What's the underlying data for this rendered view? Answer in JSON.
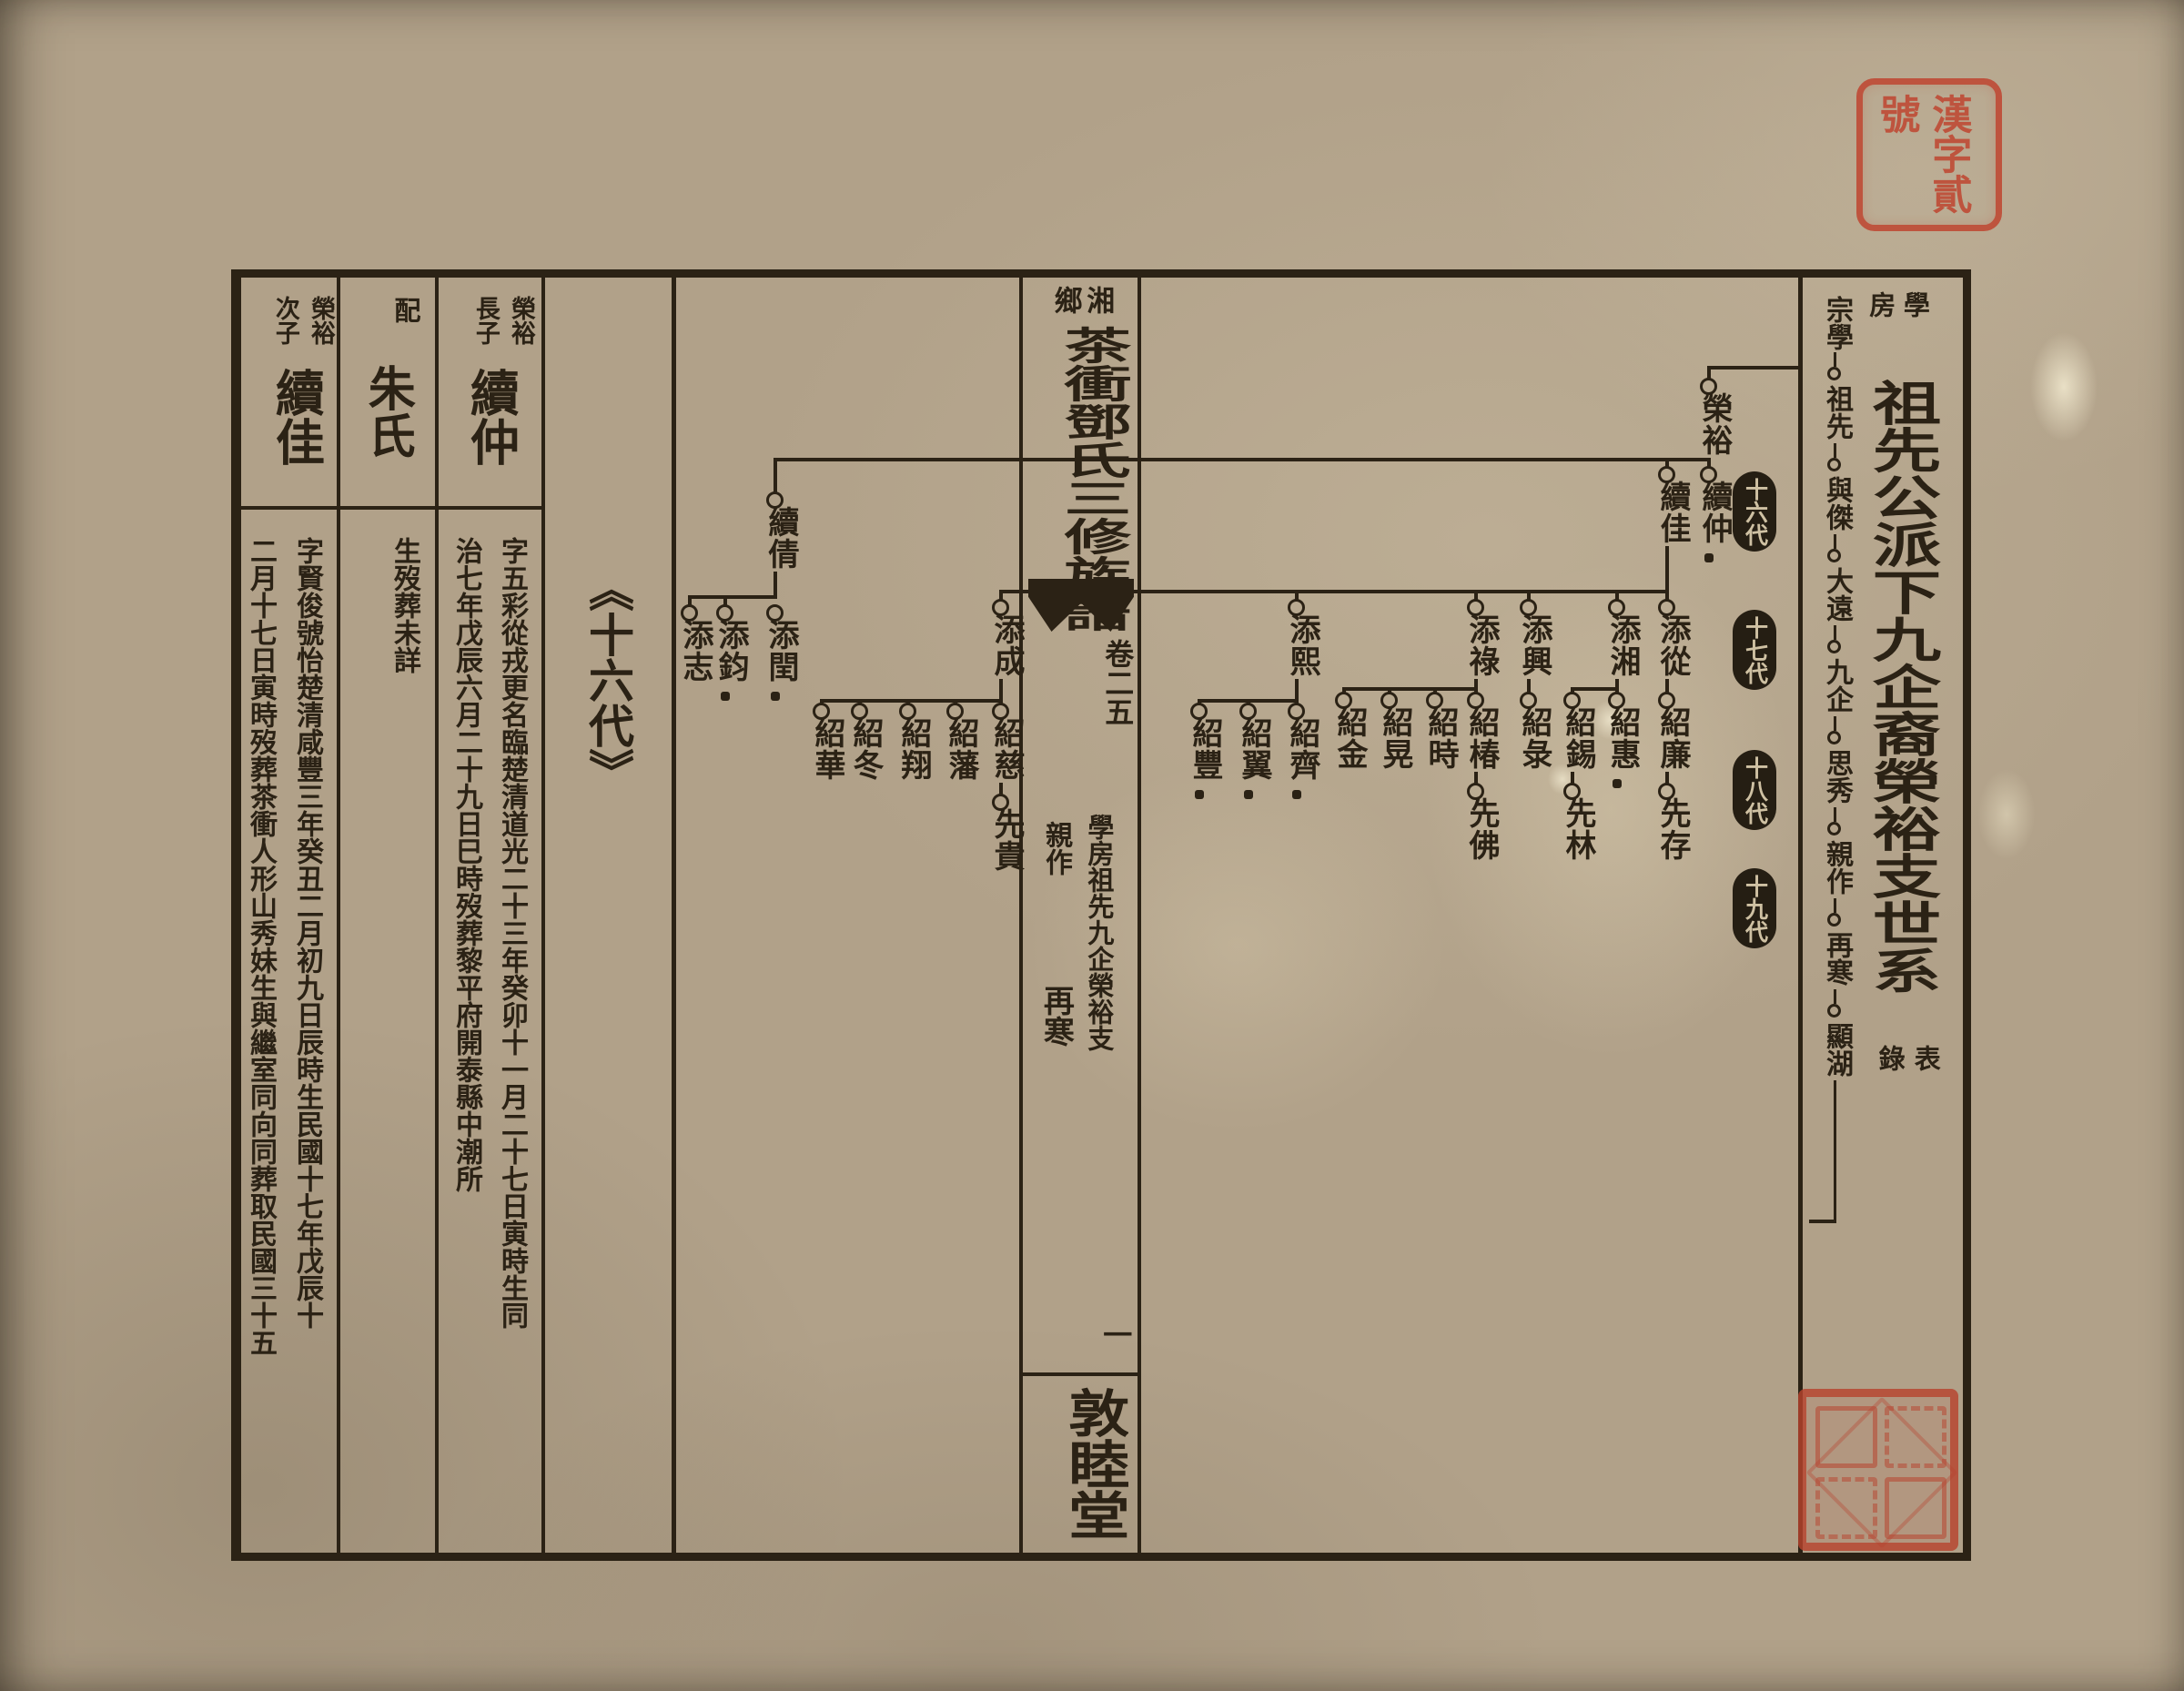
{
  "seals": {
    "registration": {
      "text": "漢字貳號",
      "color": "#bf4530"
    },
    "collection": {
      "note": "篆書藏書印"
    }
  },
  "right_panel": {
    "branch_small": "學房",
    "title_main": "祖先公派下九企裔榮裕支世系",
    "title_suffix": "表錄",
    "chain_head": "宗學",
    "chain": [
      {
        "name": "祖先"
      },
      {
        "name": "與傑"
      },
      {
        "name": "大遠"
      },
      {
        "name": "九企"
      },
      {
        "name": "思秀"
      },
      {
        "name": "親作"
      },
      {
        "name": "再寒"
      },
      {
        "name": "顯湖"
      }
    ]
  },
  "fold_column": {
    "place": "湘鄉",
    "book_title": "茶衝鄧氏三修族譜",
    "volume": "卷二五",
    "section": "學房祖先九企榮裕支",
    "compiler_top": "親作",
    "compiler_bottom": "再寒",
    "page_number": "一",
    "hall_name": "敦睦堂"
  },
  "tree": {
    "generation_labels": [
      {
        "label": "十六代"
      },
      {
        "label": "十七代"
      },
      {
        "label": "十八代"
      },
      {
        "label": "十九代"
      }
    ],
    "nodes": [
      {
        "name": "榮裕"
      },
      {
        "name": "續仲",
        "stop": true
      },
      {
        "name": "續佳"
      },
      {
        "name": "續倩"
      },
      {
        "name": "添從"
      },
      {
        "name": "添湘"
      },
      {
        "name": "添興"
      },
      {
        "name": "添祿"
      },
      {
        "name": "添熙"
      },
      {
        "name": "添成"
      },
      {
        "name": "添閏",
        "stop": true
      },
      {
        "name": "添鈞",
        "stop": true
      },
      {
        "name": "添志"
      },
      {
        "name": "紹廉"
      },
      {
        "name": "紹惠",
        "stop": true
      },
      {
        "name": "紹錫"
      },
      {
        "name": "紹彔"
      },
      {
        "name": "紹椿"
      },
      {
        "name": "紹時"
      },
      {
        "name": "紹晃"
      },
      {
        "name": "紹金"
      },
      {
        "name": "紹齊",
        "stop": true
      },
      {
        "name": "紹翼",
        "stop": true
      },
      {
        "name": "紹豐",
        "stop": true
      },
      {
        "name": "紹慈"
      },
      {
        "name": "紹藩"
      },
      {
        "name": "紹翔"
      },
      {
        "name": "紹冬"
      },
      {
        "name": "紹華"
      },
      {
        "name": "先存"
      },
      {
        "name": "先林"
      },
      {
        "name": "先佛"
      },
      {
        "name": "先貴"
      }
    ]
  },
  "left_panel": {
    "generation_marker": "《十六代》",
    "entries": [
      {
        "relation": "榮裕長子",
        "name": "續仲",
        "bio1": "字五彩從戎更名臨楚",
        "bio2": "清道光二十三年癸卯十一月二十七日寅時生同",
        "bio3": "治七年戊辰六月二十九日巳時歿葬黎平府開泰縣中潮所"
      },
      {
        "relation": "配",
        "name": "朱氏",
        "bio1": "生歿葬未詳"
      },
      {
        "relation": "榮裕次子",
        "name": "續佳",
        "bio1": "字賢俊號怡楚",
        "bio2": "清咸豐三年癸丑二月初九日辰時生民國十七年戊辰十",
        "bio3": "二月十七日寅時歿葬茶衝人形山秀妹生與繼室同向同葬取民國三十五"
      }
    ]
  }
}
